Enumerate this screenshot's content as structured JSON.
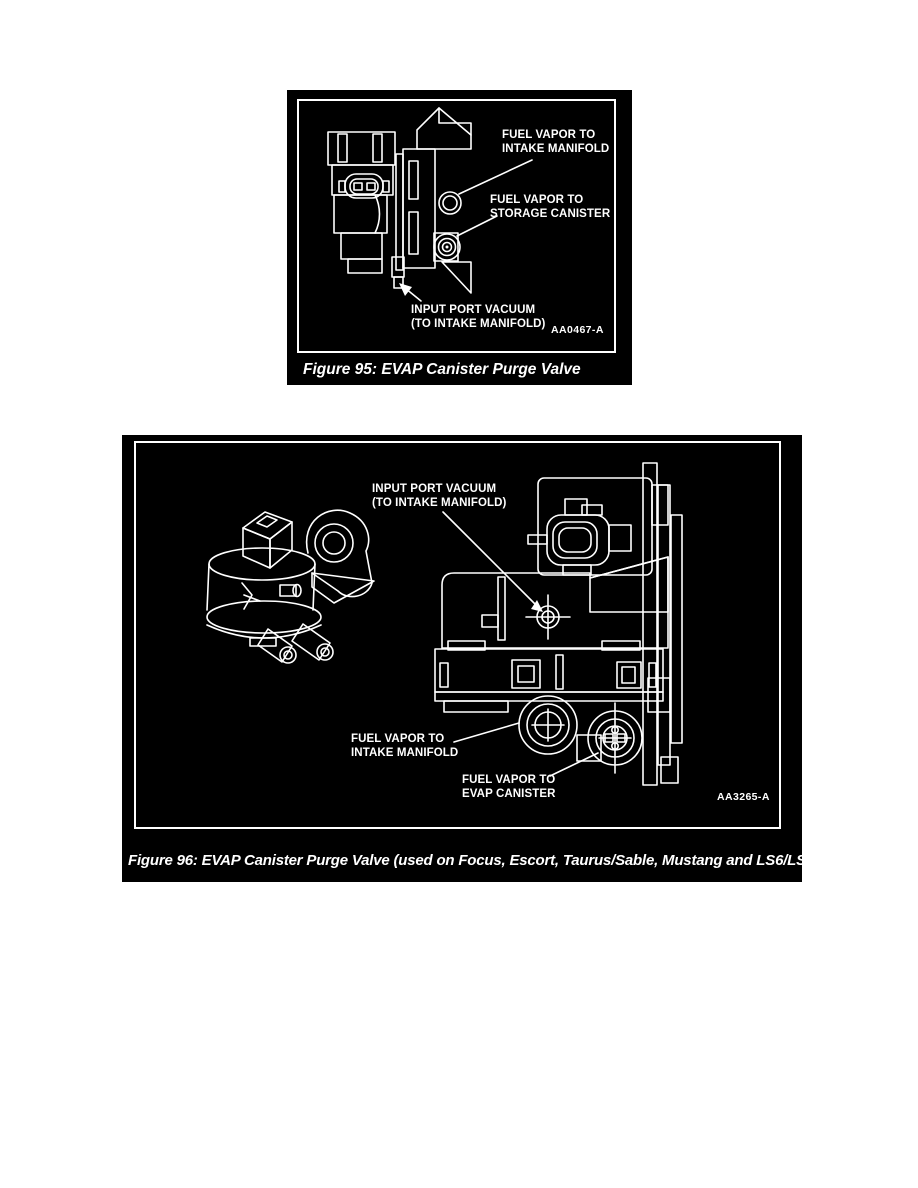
{
  "colors": {
    "page_background": "#ffffff",
    "panel_background": "#000000",
    "ink": "#ffffff"
  },
  "figure95": {
    "caption": "Figure 95: EVAP Canister Purge Valve",
    "diagram_code": "AA0467-A",
    "labels": {
      "fuel_vapor_intake": "FUEL VAPOR TO\nINTAKE MANIFOLD",
      "fuel_vapor_storage": "FUEL VAPOR TO\nSTORAGE CANISTER",
      "input_port_vacuum": "INPUT PORT VACUUM\n(TO INTAKE MANIFOLD)"
    }
  },
  "figure96": {
    "caption": "Figure 96: EVAP Canister Purge Valve (used on Focus, Escort, Taurus/Sable, Mustang and LS6/LS8)",
    "diagram_code": "AA3265-A",
    "labels": {
      "input_port_vacuum": "INPUT PORT VACUUM\n(TO INTAKE MANIFOLD)",
      "fuel_vapor_intake": "FUEL VAPOR TO\nINTAKE MANIFOLD",
      "fuel_vapor_evap": "FUEL VAPOR TO\nEVAP CANISTER"
    }
  }
}
